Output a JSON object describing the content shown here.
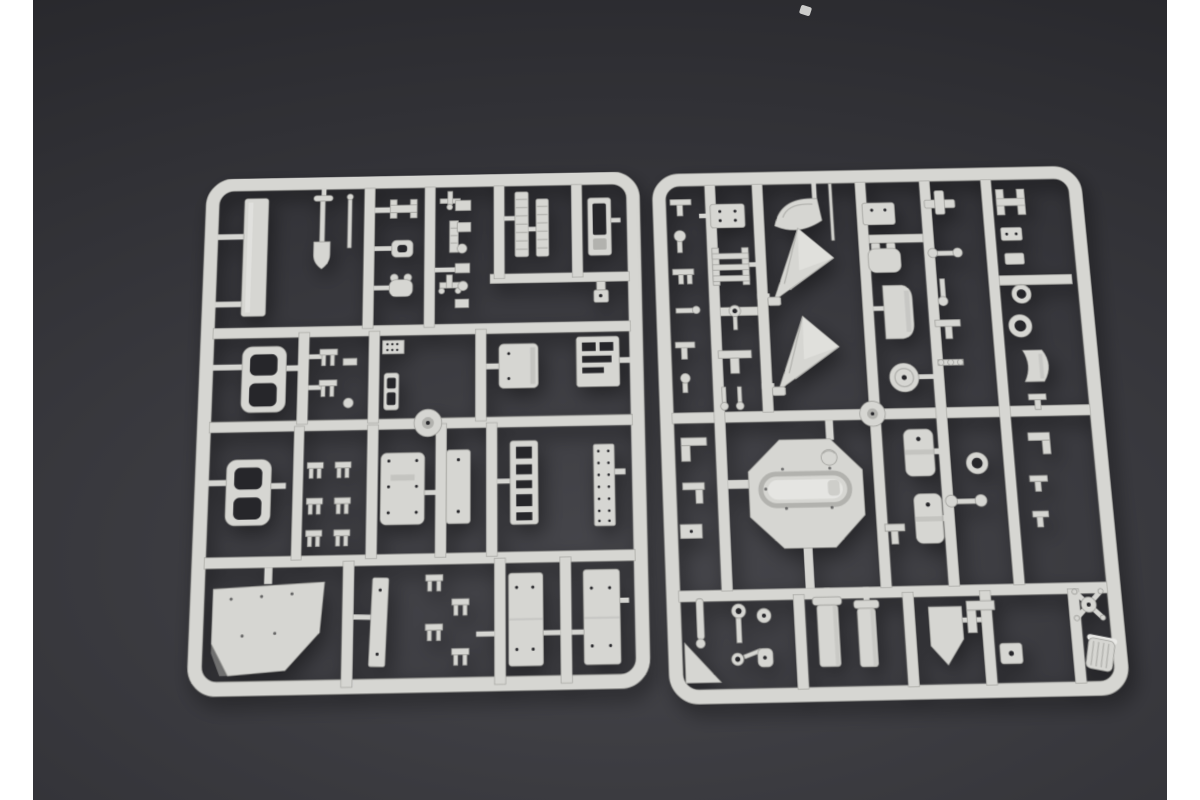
{
  "scene": {
    "type": "product-photo",
    "subject": "Two light-gray injection-molded plastic model-kit sprues (runner frames holding unassembled parts) lying side by side on a dark charcoal surface, with white vertical margins at the left and right edges of the picture",
    "colors": {
      "margin": "#ffffff",
      "surface": "#35353a",
      "surface_dark": "#232327",
      "surface_light": "#46464b",
      "plastic": "#d6d6d2",
      "plastic_bright": "#e9e9e6",
      "plastic_dark": "#b2b2ae",
      "edge": "#9e9e9a",
      "hole": "#26262a"
    },
    "sprues": [
      {
        "id": "left",
        "position": "left half, tilted slightly counter-clockwise",
        "notable_parts": [
          "long plank",
          "shovel",
          "thin rod",
          "H-shaped clips",
          "ribbed ladder strips",
          "window frame piece",
          "track frames with two openings",
          "riveted square box",
          "slotted plate",
          "round runner knob",
          "pronged clips",
          "dotted plates",
          "studded strip",
          "large mud-flap plate",
          "tall vertical plates"
        ]
      },
      {
        "id": "right",
        "position": "right half, tilted slightly counter-clockwise",
        "notable_parts": [
          "stacked small clips",
          "ladder bracket",
          "fan-shaped plate",
          "two triangular gussets",
          "thin rod",
          "octagonal turret base with oval recess",
          "round runner knob",
          "flanged cylinders",
          "two storage drums",
          "disc wheel",
          "cat-head bracket",
          "curved seat plate",
          "shield plate",
          "donut ring",
          "cup fitting",
          "curved shell",
          "axle with end discs",
          "spider coupling",
          "ribbed cylinder",
          "corner wedge"
        ]
      }
    ]
  }
}
